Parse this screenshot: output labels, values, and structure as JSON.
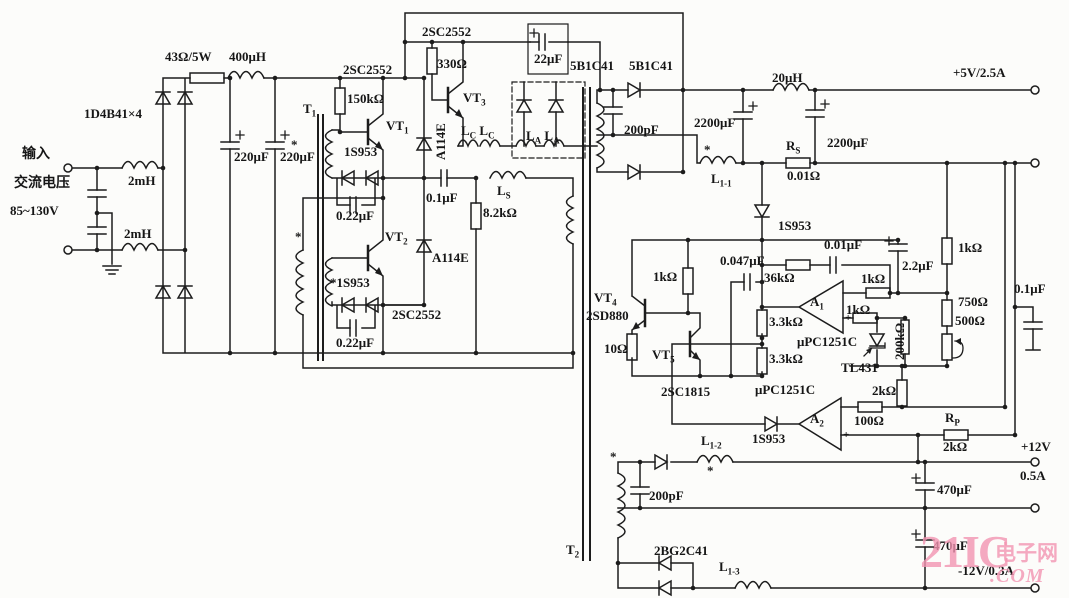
{
  "meta": {
    "description": "Switching power supply circuit schematic",
    "background": "#fcfcfa",
    "ink": "#1c1c1c",
    "watermark_color": "#f395b2"
  },
  "watermark": {
    "brand": "21IC",
    "cn": "电子网",
    "com": ".COM"
  },
  "labels": [
    {
      "id": "input-cn",
      "x": 22,
      "y": 148,
      "t": "输入",
      "fs": 14
    },
    {
      "id": "ac-voltage-cn",
      "x": 14,
      "y": 177,
      "t": "交流电压",
      "fs": 14
    },
    {
      "id": "voltage-range",
      "x": 10,
      "y": 204,
      "t": "85~130V"
    },
    {
      "id": "choke-2mh-top",
      "x": 128,
      "y": 174,
      "t": "2mH"
    },
    {
      "id": "choke-2mh-bottom",
      "x": 124,
      "y": 227,
      "t": "2mH"
    },
    {
      "id": "bridge-type",
      "x": 84,
      "y": 107,
      "t": "1D4B41×4"
    },
    {
      "id": "r-43ohm",
      "x": 165,
      "y": 50,
      "t": "43Ω/5W"
    },
    {
      "id": "l-400uh",
      "x": 229,
      "y": 50,
      "t": "400μH"
    },
    {
      "id": "c-220uf-1",
      "x": 234,
      "y": 150,
      "t": "220μF"
    },
    {
      "id": "c-220uf-2",
      "x": 280,
      "y": 150,
      "t": "220μF"
    },
    {
      "id": "t1",
      "x": 303,
      "y": 102,
      "parts": [
        {
          "t": "T"
        },
        {
          "t": "1",
          "sub": true
        }
      ]
    },
    {
      "id": "q-2sc2552-vt1",
      "x": 343,
      "y": 63,
      "t": "2SC2552"
    },
    {
      "id": "r-150k",
      "x": 347,
      "y": 92,
      "t": "150kΩ"
    },
    {
      "id": "vt1",
      "x": 386,
      "y": 119,
      "parts": [
        {
          "t": "VT"
        },
        {
          "t": "1",
          "sub": true
        }
      ]
    },
    {
      "id": "star-1",
      "x": 291,
      "y": 138,
      "t": "*"
    },
    {
      "id": "d-1s953-1",
      "x": 344,
      "y": 145,
      "t": "1S953"
    },
    {
      "id": "c-022uf-1",
      "x": 336,
      "y": 209,
      "t": "0.22μF"
    },
    {
      "id": "d-a114e-1",
      "x": 434,
      "y": 160,
      "t": "A114E",
      "rot": -90
    },
    {
      "id": "vt3",
      "x": 463,
      "y": 91,
      "parts": [
        {
          "t": "VT"
        },
        {
          "t": "3",
          "sub": true
        }
      ]
    },
    {
      "id": "q-2sc2552-vt3",
      "x": 422,
      "y": 25,
      "t": "2SC2552"
    },
    {
      "id": "r-330",
      "x": 437,
      "y": 57,
      "t": "330Ω"
    },
    {
      "id": "c-22uf",
      "x": 534,
      "y": 52,
      "t": "22μF"
    },
    {
      "id": "d-5b1c41-1",
      "x": 570,
      "y": 59,
      "t": "5B1C41"
    },
    {
      "id": "d-5b1c41-2",
      "x": 629,
      "y": 59,
      "t": "5B1C41"
    },
    {
      "id": "l-lc",
      "x": 461,
      "y": 124,
      "parts": [
        {
          "t": "L"
        },
        {
          "t": "C",
          "sub": true
        },
        {
          "t": " L"
        },
        {
          "t": "C",
          "sub": true
        }
      ]
    },
    {
      "id": "l-la",
      "x": 526,
      "y": 129,
      "parts": [
        {
          "t": "L"
        },
        {
          "t": "A",
          "sub": true
        },
        {
          "t": " L"
        },
        {
          "t": "A",
          "sub": true
        }
      ]
    },
    {
      "id": "c-01uf-1",
      "x": 426,
      "y": 191,
      "t": "0.1μF"
    },
    {
      "id": "l-ls",
      "x": 497,
      "y": 184,
      "parts": [
        {
          "t": "L"
        },
        {
          "t": "S",
          "sub": true
        }
      ]
    },
    {
      "id": "r-82k",
      "x": 483,
      "y": 206,
      "t": "8.2kΩ"
    },
    {
      "id": "star-2",
      "x": 295,
      "y": 230,
      "t": "*"
    },
    {
      "id": "vt2",
      "x": 385,
      "y": 230,
      "parts": [
        {
          "t": "VT"
        },
        {
          "t": "2",
          "sub": true
        }
      ]
    },
    {
      "id": "d-a114e-2",
      "x": 432,
      "y": 251,
      "t": "A114E"
    },
    {
      "id": "d-1s953-2",
      "x": 330,
      "y": 276,
      "t": "*1S953"
    },
    {
      "id": "c-022uf-2",
      "x": 336,
      "y": 336,
      "t": "0.22μF"
    },
    {
      "id": "q-2sc2552-vt2",
      "x": 392,
      "y": 308,
      "t": "2SC2552"
    },
    {
      "id": "t2",
      "x": 566,
      "y": 543,
      "parts": [
        {
          "t": "T"
        },
        {
          "t": "2",
          "sub": true
        }
      ]
    },
    {
      "id": "c-200pf-top",
      "x": 624,
      "y": 123,
      "t": "200pF"
    },
    {
      "id": "c-2200uf-1",
      "x": 694,
      "y": 116,
      "t": "2200μF"
    },
    {
      "id": "l-1-1",
      "x": 711,
      "y": 172,
      "parts": [
        {
          "t": "L"
        },
        {
          "t": "1-1",
          "sub": true
        }
      ]
    },
    {
      "id": "star-3",
      "x": 704,
      "y": 143,
      "t": "*"
    },
    {
      "id": "l-20uh",
      "x": 772,
      "y": 71,
      "t": "20μH"
    },
    {
      "id": "c-2200uf-2",
      "x": 827,
      "y": 136,
      "t": "2200μF"
    },
    {
      "id": "r-rs",
      "x": 786,
      "y": 139,
      "parts": [
        {
          "t": "R"
        },
        {
          "t": "S",
          "sub": true
        }
      ]
    },
    {
      "id": "r-001ohm",
      "x": 787,
      "y": 169,
      "t": "0.01Ω"
    },
    {
      "id": "out-5v",
      "x": 953,
      "y": 66,
      "t": "+5V/2.5A"
    },
    {
      "id": "d-1s953-3",
      "x": 778,
      "y": 219,
      "t": "1S953"
    },
    {
      "id": "c-001uf",
      "x": 824,
      "y": 238,
      "t": "0.01μF"
    },
    {
      "id": "c-0047uf",
      "x": 720,
      "y": 254,
      "t": "0.047μF"
    },
    {
      "id": "r-36k",
      "x": 764,
      "y": 271,
      "t": "36kΩ"
    },
    {
      "id": "a1",
      "x": 810,
      "y": 295,
      "parts": [
        {
          "t": "A"
        },
        {
          "t": "1",
          "sub": true
        }
      ]
    },
    {
      "id": "r-1k-a1-top",
      "x": 861,
      "y": 272,
      "t": "1kΩ"
    },
    {
      "id": "r-1k-a1-bot",
      "x": 846,
      "y": 303,
      "t": "1kΩ"
    },
    {
      "id": "c-22uf-small",
      "x": 902,
      "y": 259,
      "t": "2.2μF"
    },
    {
      "id": "ic-upc1251c-1",
      "x": 797,
      "y": 335,
      "t": "μPC1251C"
    },
    {
      "id": "r-33k-1",
      "x": 769,
      "y": 315,
      "t": "3.3kΩ"
    },
    {
      "id": "r-33k-2",
      "x": 769,
      "y": 352,
      "t": "3.3kΩ"
    },
    {
      "id": "ic-tl431",
      "x": 841,
      "y": 361,
      "t": "TL431"
    },
    {
      "id": "r-200k",
      "x": 893,
      "y": 360,
      "t": "200kΩ",
      "rot": -90
    },
    {
      "id": "r-1k-right",
      "x": 958,
      "y": 241,
      "t": "1kΩ"
    },
    {
      "id": "r-750",
      "x": 958,
      "y": 295,
      "t": "750Ω"
    },
    {
      "id": "r-500",
      "x": 955,
      "y": 314,
      "t": "500Ω"
    },
    {
      "id": "c-01uf-2",
      "x": 1014,
      "y": 282,
      "t": "0.1μF"
    },
    {
      "id": "vt4",
      "x": 594,
      "y": 291,
      "parts": [
        {
          "t": "VT"
        },
        {
          "t": "4",
          "sub": true
        }
      ]
    },
    {
      "id": "q-2sd880",
      "x": 586,
      "y": 309,
      "t": "2SD880"
    },
    {
      "id": "r-1k-vt4",
      "x": 653,
      "y": 270,
      "t": "1kΩ"
    },
    {
      "id": "r-10ohm",
      "x": 604,
      "y": 342,
      "t": "10Ω"
    },
    {
      "id": "vt5",
      "x": 652,
      "y": 348,
      "parts": [
        {
          "t": "VT"
        },
        {
          "t": "5",
          "sub": true
        }
      ]
    },
    {
      "id": "q-2sc1815",
      "x": 661,
      "y": 385,
      "t": "2SC1815"
    },
    {
      "id": "ic-upc1251c-2",
      "x": 755,
      "y": 383,
      "t": "μPC1251C"
    },
    {
      "id": "a2",
      "x": 810,
      "y": 412,
      "parts": [
        {
          "t": "A"
        },
        {
          "t": "2",
          "sub": true
        }
      ]
    },
    {
      "id": "d-1s953-4",
      "x": 752,
      "y": 432,
      "t": "1S953"
    },
    {
      "id": "r-2k-1",
      "x": 872,
      "y": 384,
      "t": "2kΩ"
    },
    {
      "id": "r-100ohm",
      "x": 854,
      "y": 414,
      "t": "100Ω"
    },
    {
      "id": "r-rp",
      "x": 945,
      "y": 411,
      "parts": [
        {
          "t": "R"
        },
        {
          "t": "P",
          "sub": true
        }
      ]
    },
    {
      "id": "r-2k-rp",
      "x": 943,
      "y": 440,
      "t": "2kΩ"
    },
    {
      "id": "l-1-2",
      "x": 701,
      "y": 434,
      "parts": [
        {
          "t": "L"
        },
        {
          "t": "1-2",
          "sub": true
        }
      ]
    },
    {
      "id": "star-4",
      "x": 707,
      "y": 464,
      "t": "*"
    },
    {
      "id": "star-5",
      "x": 610,
      "y": 450,
      "t": "*"
    },
    {
      "id": "c-200pf-bottom",
      "x": 649,
      "y": 489,
      "t": "200pF"
    },
    {
      "id": "d-2bg2c41",
      "x": 654,
      "y": 544,
      "t": "2BG2C41"
    },
    {
      "id": "l-1-3",
      "x": 719,
      "y": 560,
      "parts": [
        {
          "t": "L"
        },
        {
          "t": "1-3",
          "sub": true
        }
      ]
    },
    {
      "id": "out-12v",
      "x": 1021,
      "y": 440,
      "t": "+12V"
    },
    {
      "id": "out-05a",
      "x": 1020,
      "y": 469,
      "t": "0.5A"
    },
    {
      "id": "c-470uf-1",
      "x": 937,
      "y": 483,
      "t": "470μF"
    },
    {
      "id": "c-470uf-2",
      "x": 933,
      "y": 539,
      "t": "470μF"
    },
    {
      "id": "out-neg12v",
      "x": 958,
      "y": 564,
      "t": "-12V/0.3A"
    },
    {
      "id": "a1-plus",
      "x": 845,
      "y": 313,
      "t": "+",
      "fs": 11
    },
    {
      "id": "a2-plus",
      "x": 843,
      "y": 430,
      "t": "+",
      "fs": 11
    }
  ]
}
